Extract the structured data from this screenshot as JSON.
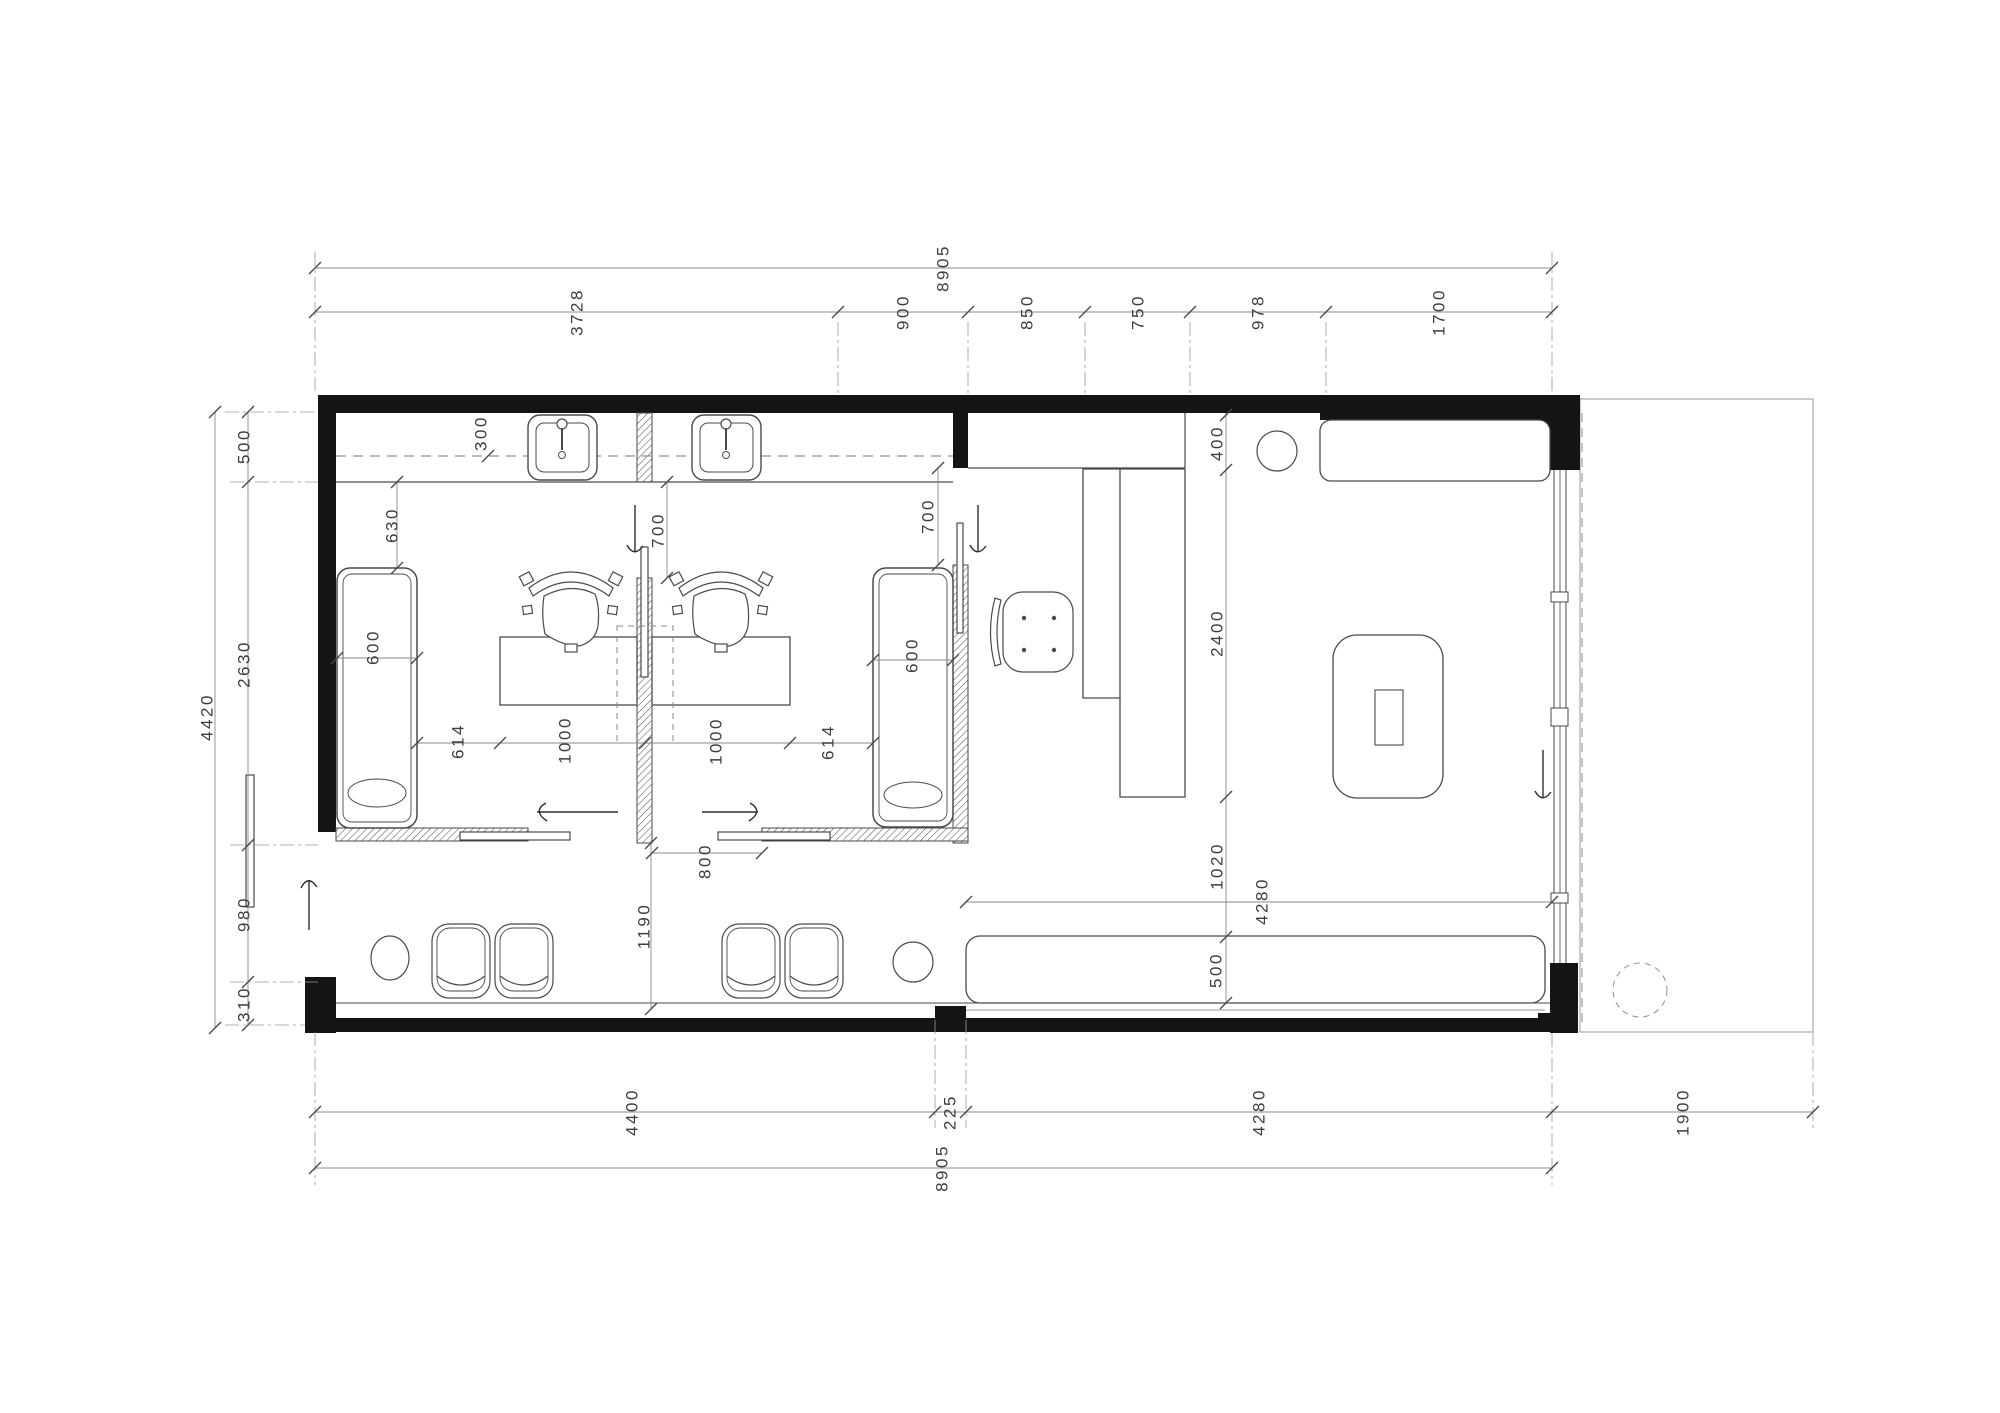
{
  "drawing": {
    "type": "architectural-floor-plan",
    "units": "mm",
    "colors": {
      "wall": "#141414",
      "furniture_line": "#4a4a4a",
      "dim_line": "#8a8a8a",
      "label_text": "#3d3d3d",
      "background": "#ffffff"
    }
  },
  "dimensions": {
    "overall_width_top": "8905",
    "top_segments": [
      "3728",
      "900",
      "850",
      "750",
      "978",
      "1700"
    ],
    "overall_height": "4420",
    "left_segments": [
      "500",
      "2630",
      "980",
      "310"
    ],
    "bottom_segments": [
      "4400",
      "225",
      "4280"
    ],
    "overall_width_bottom": "8905",
    "terrace_width": "1900",
    "room1": {
      "counter_offset": "300",
      "bed_clearance": "630",
      "bed_width": "600",
      "door_clearance": "700",
      "desk_width": "1000",
      "desk_gap": "614"
    },
    "room2": {
      "desk_width": "1000",
      "desk_gap": "614",
      "bed_width": "600",
      "door_clearance": "700",
      "door_opening": "800"
    },
    "corridor_width": "1190",
    "reception": {
      "cabinet_depth": "400",
      "room_depth": "2400",
      "sofa_clearance": "1020",
      "sofa_depth": "500",
      "sofa_length": "4280"
    }
  }
}
